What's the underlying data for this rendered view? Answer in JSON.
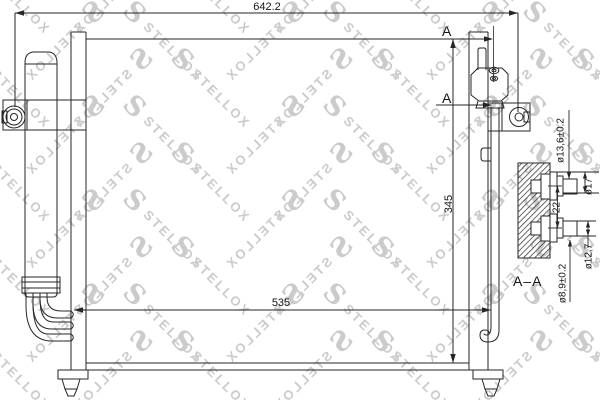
{
  "drawing": {
    "dimensions": {
      "overall_width": "642.2",
      "core_height": "345",
      "core_width": "535"
    },
    "section": {
      "marker_top": "A",
      "marker_bottom": "A",
      "label": "A–A",
      "port_dims": {
        "upper_tube": "ø13,6±0.2",
        "upper_flange": "ø17",
        "port_spacing": "22",
        "lower_flange": "ø12,7",
        "lower_tube": "ø8,9±0.2"
      }
    }
  },
  "watermark": {
    "brand": "STELLOX",
    "logo_char": "S",
    "color": "#cbcbcb"
  },
  "colors": {
    "line": "#262626",
    "background": "#ffffff",
    "text": "#151515"
  }
}
